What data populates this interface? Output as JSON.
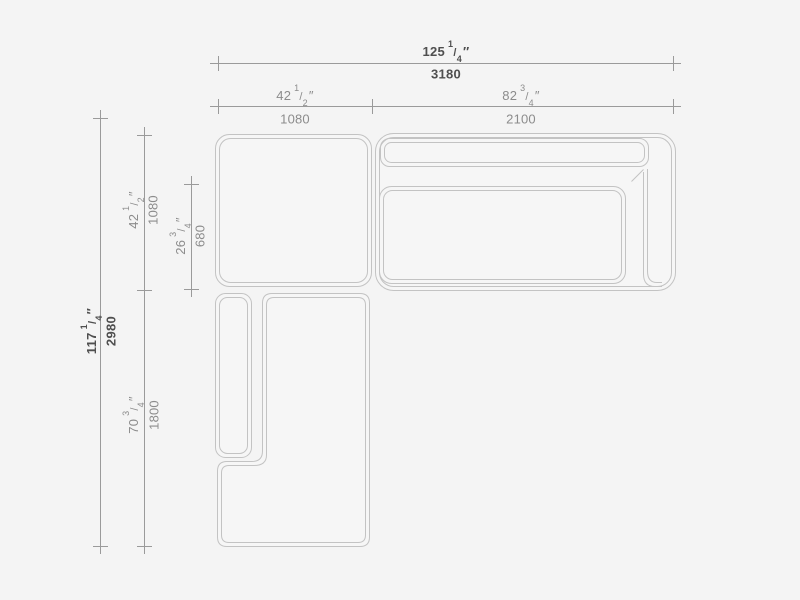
{
  "drawing": {
    "name": "sectional-sofa-plan-dimension-drawing",
    "view": "top"
  },
  "glyphs": {
    "frac_slash": "/",
    "inch_mark": "″"
  },
  "colors": {
    "background": "#f4f4f4",
    "sofa_outline": "#c3c3c3",
    "sofa_fill": "#f6f6f6",
    "dim_line": "#9a9a9a",
    "text_regular": "#8c8c8c",
    "text_bold": "#4f4f4f"
  },
  "dims": {
    "overall_width": {
      "in_whole": "125",
      "in_num": "1",
      "in_den": "4",
      "mm": "3180"
    },
    "module_left_width": {
      "in_whole": "42",
      "in_num": "1",
      "in_den": "2",
      "mm": "1080"
    },
    "module_right_width": {
      "in_whole": "82",
      "in_num": "3",
      "in_den": "4",
      "mm": "2100"
    },
    "overall_depth": {
      "in_whole": "117",
      "in_num": "1",
      "in_den": "4",
      "mm": "2980"
    },
    "module_top_depth": {
      "in_whole": "42",
      "in_num": "1",
      "in_den": "2",
      "mm": "1080"
    },
    "seat_depth": {
      "in_whole": "26",
      "in_num": "3",
      "in_den": "4",
      "mm": "680"
    },
    "chaise_length": {
      "in_whole": "70",
      "in_num": "3",
      "in_den": "4",
      "mm": "1800"
    }
  }
}
